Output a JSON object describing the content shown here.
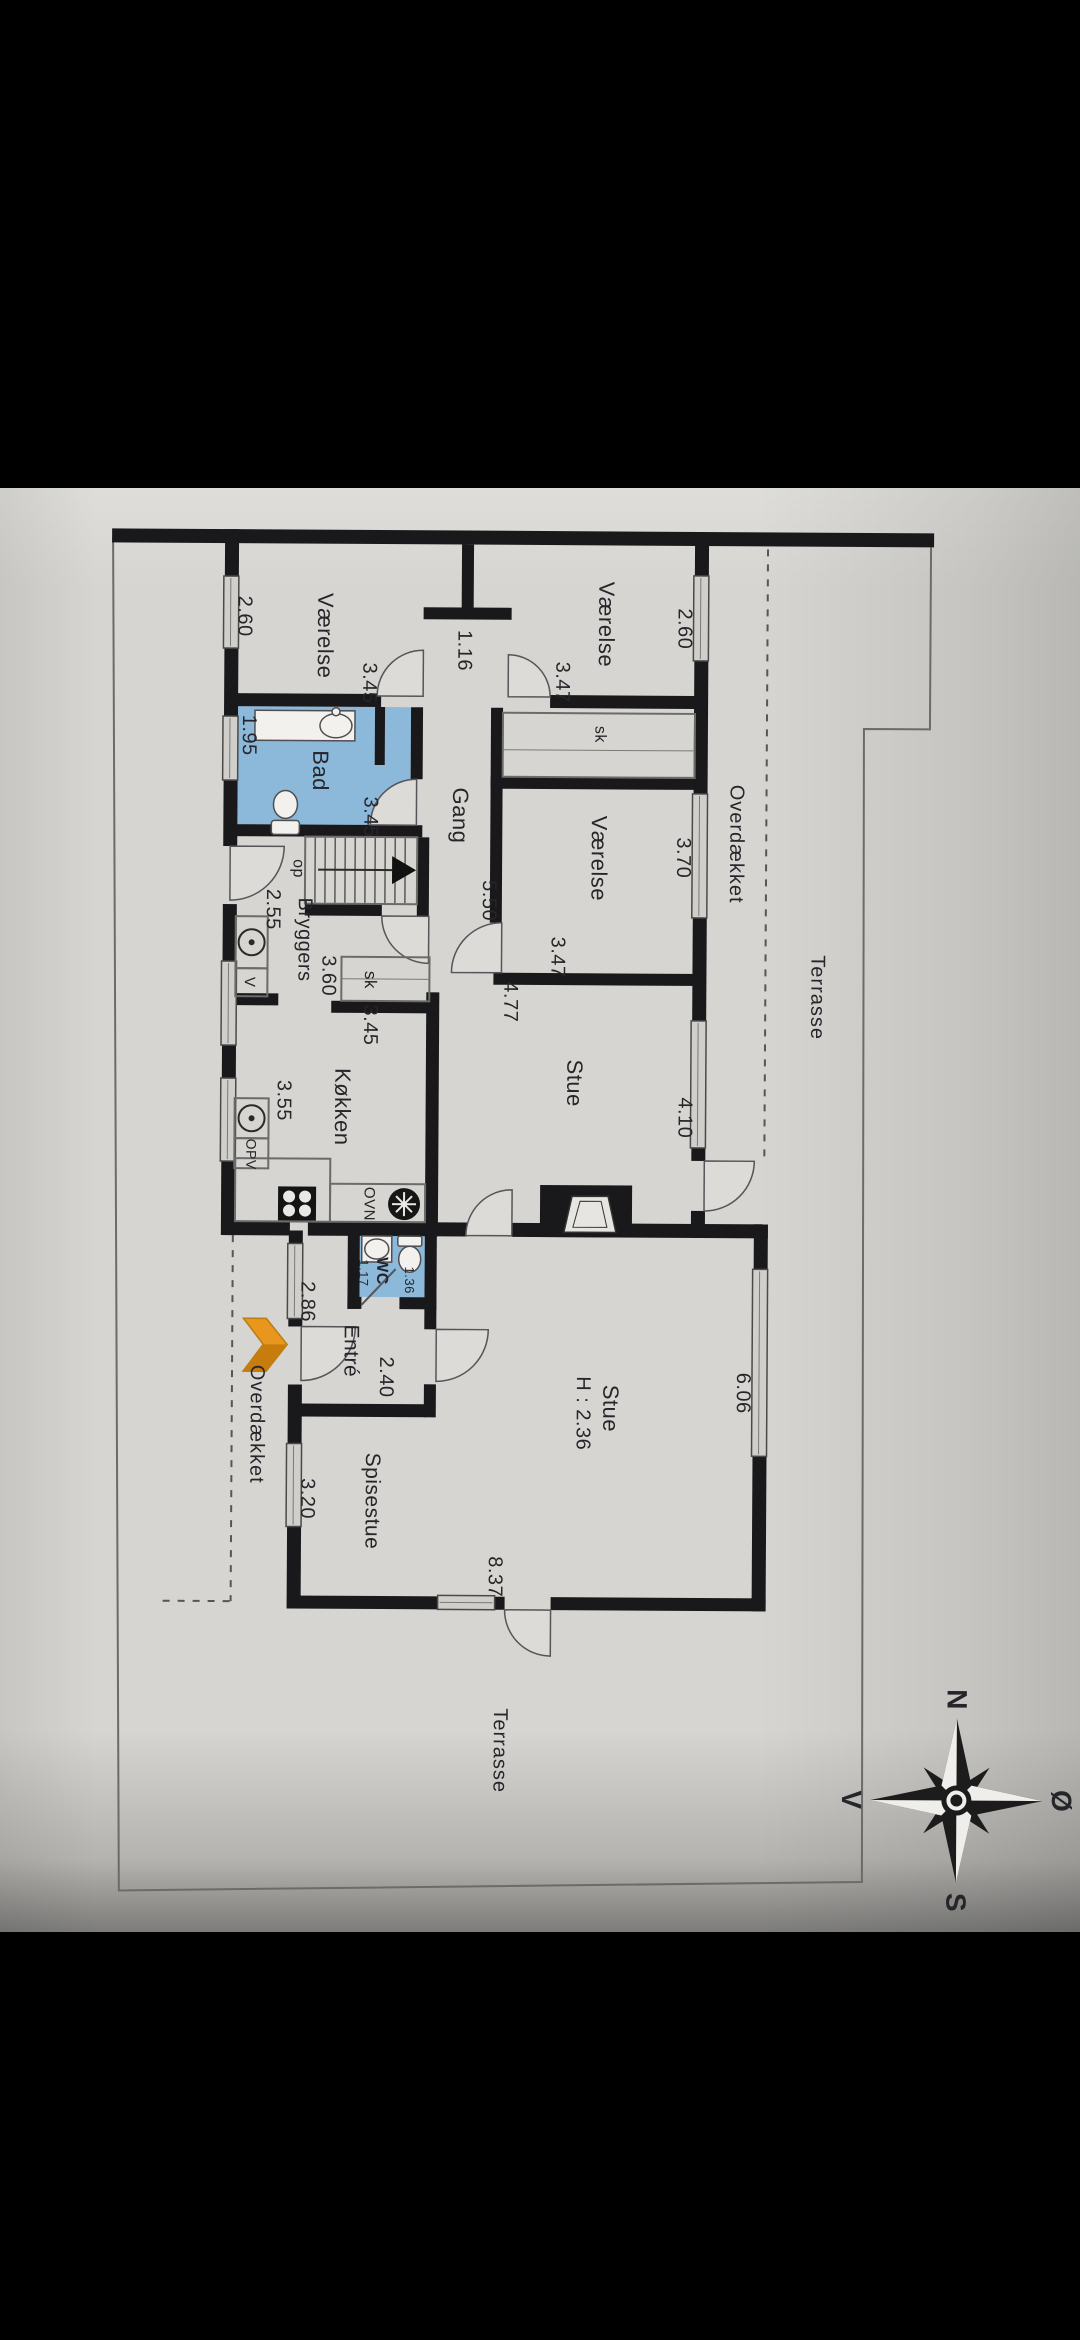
{
  "floorplan": {
    "rooms": {
      "vaerelse_top_left": "Værelse",
      "vaerelse_top_middle": "Værelse",
      "vaerelse_middle": "Værelse",
      "bad": "Bad",
      "gang": "Gang",
      "bryggers": "Bryggers",
      "koekken": "Køkken",
      "stue_upper": "Stue",
      "wc": "WC",
      "entre": "Entré",
      "spisestue": "Spisestue",
      "stue_lower": "Stue",
      "stue_lower_height": "H : 2.36"
    },
    "dims": {
      "tl_width": "2.60",
      "tl_length": "3.45",
      "door_width": "1.16",
      "tm_length": "3.47",
      "tm_width": "2.60",
      "bad_width": "1.95",
      "bad_length": "3.45",
      "gang_length": "5.50",
      "bryggers_width": "2.55",
      "sk_width": "3.60",
      "sk_length": "3.45",
      "mid_length": "3.47",
      "mid_width": "3.70",
      "stue_upper_width": "4.77",
      "stue_upper_window": "4.10",
      "koekken_width": "3.55",
      "wc_width": "1.17",
      "wc_length": "1.36",
      "entre_window": "2.86",
      "entre_width": "2.40",
      "spisestue_window": "3.20",
      "stue_lower_window": "6.06",
      "bottom_wall": "8.37"
    },
    "features": {
      "sk_upper": "sk",
      "sk_middle": "sk",
      "op": "op",
      "v_appliance": "V",
      "ovn": "OVN",
      "opv": "OPV"
    },
    "areas": {
      "overdaekket_east": "Overdækket",
      "terrasse_east": "Terrasse",
      "overdaekket_west": "Overdækket",
      "terrasse_south": "Terrasse"
    },
    "compass": {
      "north": "N",
      "south": "S",
      "west": "V",
      "east": "Ø"
    }
  }
}
